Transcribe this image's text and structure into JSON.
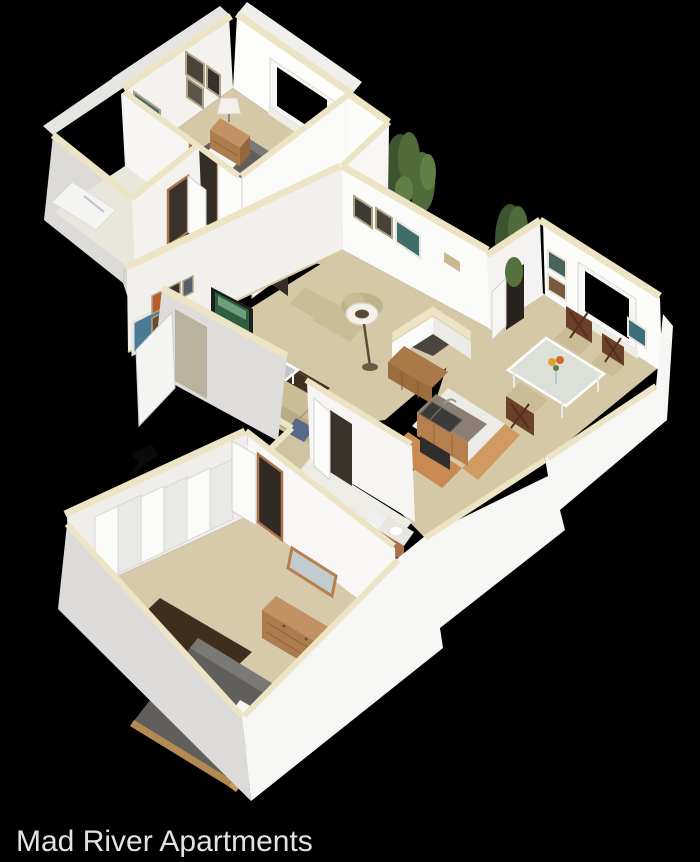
{
  "caption": {
    "text": "Mad River Apartments",
    "color": "#e3e3e3"
  },
  "background_color": "#000000",
  "scene": {
    "kind": "3d-isometric-floorplan-render",
    "rooms": [
      "bedroom-1",
      "bathroom-1",
      "hallway",
      "living-room",
      "dining-area",
      "kitchen",
      "bathroom-2",
      "master-bedroom"
    ],
    "entry_marker": "black-arrow-pointing-at-entry-door"
  },
  "palette": {
    "wall_top_trim": "#ece4c5",
    "wall_face_bright": "#fbfbfa",
    "wall_face_shaded": "#e3e2df",
    "exterior_face": "#f6f6f5",
    "exterior_face_shadow": "#d9d8d6",
    "carpet": "#d5c8a6",
    "tile": "#edece6",
    "wood_furniture": "#b5804d",
    "wood_floor": "#c98a52",
    "area_rug": "#42301e",
    "bedding_gray": "#615f5c",
    "sofa_beige": "#cabd96",
    "accent_pillow_blue": "#5b6f8c",
    "foliage_green": "#4e6b39",
    "window_glass": "#000000"
  }
}
